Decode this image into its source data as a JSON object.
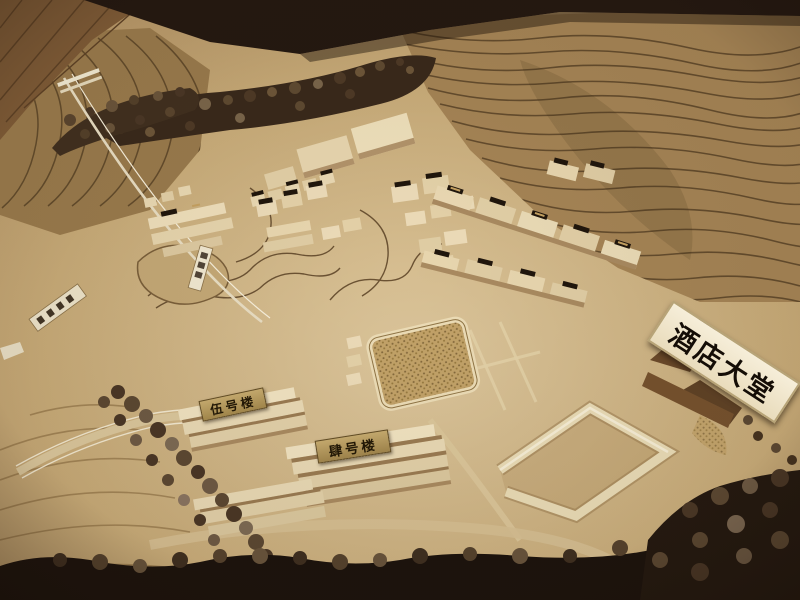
{
  "signs": {
    "hotel_lobby": "酒店大堂",
    "building_no5": "伍号楼",
    "building_no4": "肆号楼"
  },
  "palette": {
    "backdrop_dark": "#241811",
    "wood_floor": "#7d5a36",
    "terrain_base": "#b3925f",
    "contour_line": "#5a4326",
    "ground_light": "#dcc69c",
    "building_wood": "#ecdbb8",
    "tree_dark": "#3c2c1c",
    "sign_background": "#f4ecd6",
    "sign_text": "#140d06",
    "plaque_bronze": "#ad9055"
  }
}
